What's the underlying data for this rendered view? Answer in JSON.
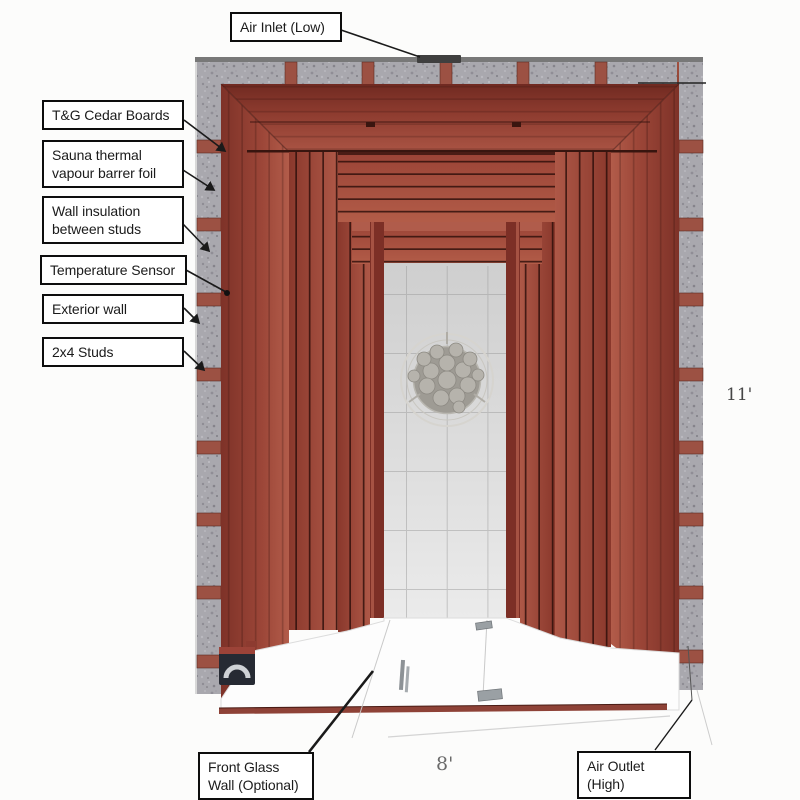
{
  "diagram": {
    "callouts": {
      "air_inlet": "Air Inlet (Low)",
      "tg_cedar_boards": "T&G Cedar Boards",
      "vapour_barrier": "Sauna thermal vapour barrer foil",
      "wall_insulation": "Wall insulation between studs",
      "temperature_sensor": "Temperature Sensor",
      "exterior_wall": "Exterior wall",
      "studs": "2x4 Studs",
      "front_glass_wall": "Front Glass Wall (Optional)",
      "air_outlet": "Air Outlet (High)"
    },
    "dimensions": {
      "depth_ft": "11'",
      "width_ft": "8'"
    },
    "colors": {
      "cedar": "#9c4a3d",
      "cedar_dark": "#6f2a22",
      "slat_gap": "#2a0d08",
      "insulation_gray": "#a9a8ae",
      "stud_red": "#9c5143",
      "tile_gray": "#d9d9d9",
      "heater_stone": "#b6b3ac",
      "label_border": "#0d0d0d",
      "background": "#fcfcfb"
    }
  }
}
